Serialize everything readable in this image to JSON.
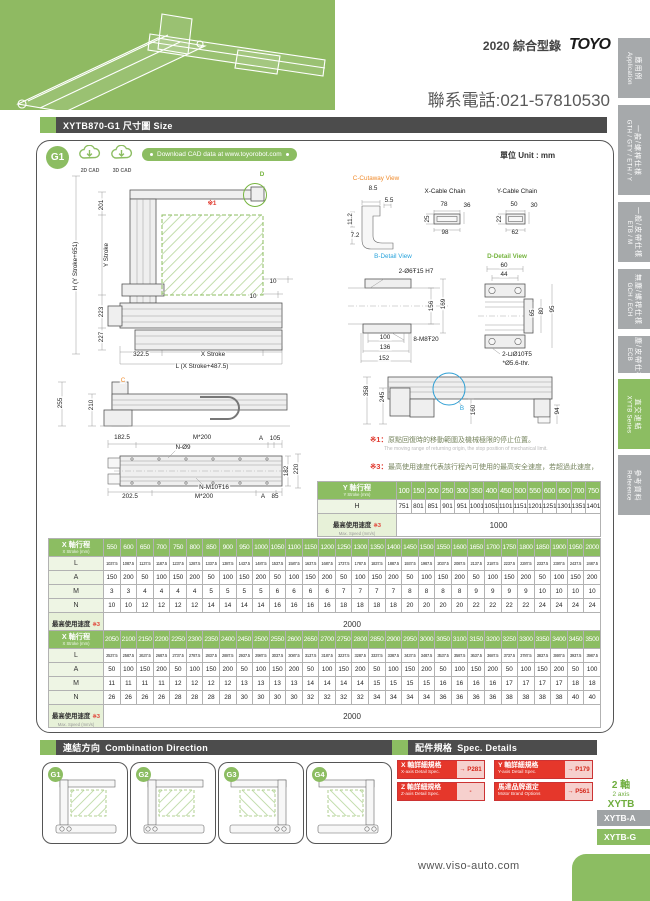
{
  "header": {
    "edition": "2020 綜合型錄",
    "logo": "TOYO",
    "phone": "聯系電話:021-57810530"
  },
  "sidebar": {
    "tabs": [
      {
        "zh": "應用例",
        "en": "Application"
      },
      {
        "zh": "一般/螺桿仕樣",
        "en": "GTH / GTY / ETH / Y"
      },
      {
        "zh": "一般/皮帶仕樣",
        "en": "ETB / M"
      },
      {
        "zh": "無塵/螺桿仕樣",
        "en": "GCH / ECH"
      },
      {
        "zh": "無塵/皮帶仕樣",
        "en": "ECB"
      },
      {
        "zh": "直交連結",
        "en": "XYTB Series"
      },
      {
        "zh": "參考資料",
        "en": "Reference"
      }
    ]
  },
  "size_section": {
    "title": "XYTB870-G1 尺寸圖 Size",
    "badge": "G1",
    "cad_2d": "2D CAD",
    "cad_3d": "3D CAD",
    "download": "Download CAD data at www.toyorobot.com",
    "unit": "單位 Unit : mm"
  },
  "drawings": {
    "front": {
      "labels": [
        {
          "t": "D",
          "x": 210,
          "y": 9,
          "c": "green"
        },
        {
          "t": "※1",
          "x": 160,
          "y": 38,
          "c": "red"
        },
        {
          "t": "H (Y Stroke+651)",
          "x": 24,
          "y": 100,
          "r": -90
        },
        {
          "t": "201",
          "x": 50,
          "y": 39,
          "r": -90
        },
        {
          "t": "Y Stroke",
          "x": 55,
          "y": 89,
          "r": -90
        },
        {
          "t": "223",
          "x": 50,
          "y": 146,
          "r": -90
        },
        {
          "t": "227",
          "x": 50,
          "y": 171,
          "r": -90
        },
        {
          "t": "10",
          "x": 221,
          "y": 116
        },
        {
          "t": "10",
          "x": 201,
          "y": 131
        },
        {
          "t": "322.5",
          "x": 89,
          "y": 189
        },
        {
          "t": "X Stroke",
          "x": 161,
          "y": 189
        },
        {
          "t": "L (X Stroke+487.5)",
          "x": 150,
          "y": 201
        }
      ]
    },
    "details": {
      "labels": [
        {
          "t": "C-Cutaway View",
          "x": 28,
          "y": 7,
          "c": "orange"
        },
        {
          "t": "8.5",
          "x": 25,
          "y": 17
        },
        {
          "t": "5.5",
          "x": 41,
          "y": 29
        },
        {
          "t": "11.2",
          "x": 3,
          "y": 47,
          "r": -90
        },
        {
          "t": "7.2",
          "x": 7,
          "y": 64
        },
        {
          "t": "X-Cable Chain",
          "x": 97,
          "y": 20
        },
        {
          "t": "78",
          "x": 96,
          "y": 33
        },
        {
          "t": "36",
          "x": 119,
          "y": 34
        },
        {
          "t": "25",
          "x": 80,
          "y": 47,
          "r": -90
        },
        {
          "t": "98",
          "x": 97,
          "y": 61
        },
        {
          "t": "Y-Cable Chain",
          "x": 169,
          "y": 20
        },
        {
          "t": "50",
          "x": 166,
          "y": 33
        },
        {
          "t": "30",
          "x": 186,
          "y": 34
        },
        {
          "t": "22",
          "x": 152,
          "y": 47,
          "r": -90
        },
        {
          "t": "62",
          "x": 167,
          "y": 61
        },
        {
          "t": "B-Detail View",
          "x": 45,
          "y": 85,
          "c": "blue"
        },
        {
          "t": "2-Ø6Ŧ15 H7",
          "x": 68,
          "y": 100
        },
        {
          "t": "156",
          "x": 84,
          "y": 134,
          "r": -90
        },
        {
          "t": "169",
          "x": 96,
          "y": 132,
          "r": -90
        },
        {
          "t": "100",
          "x": 37,
          "y": 166
        },
        {
          "t": "8-M8Ŧ20",
          "x": 78,
          "y": 168
        },
        {
          "t": "136",
          "x": 37,
          "y": 176
        },
        {
          "t": "152",
          "x": 36,
          "y": 187
        },
        {
          "t": "D-Detail View",
          "x": 159,
          "y": 85,
          "c": "green"
        },
        {
          "t": "60",
          "x": 156,
          "y": 94
        },
        {
          "t": "44",
          "x": 156,
          "y": 103
        },
        {
          "t": "65",
          "x": 185,
          "y": 141,
          "r": -90
        },
        {
          "t": "80",
          "x": 194,
          "y": 139,
          "r": -90
        },
        {
          "t": "95",
          "x": 205,
          "y": 137,
          "r": -90
        },
        {
          "t": "2-⊔Ø10Ŧ5",
          "x": 169,
          "y": 183
        },
        {
          "t": "*Ø5.6-thr.",
          "x": 168,
          "y": 192
        }
      ]
    },
    "side_top": {
      "labels": [
        {
          "t": "255",
          "x": 9,
          "y": 29,
          "r": -90
        },
        {
          "t": "210",
          "x": 40,
          "y": 31,
          "r": -90
        },
        {
          "t": "C",
          "x": 71,
          "y": 7,
          "c": "orange"
        },
        {
          "t": "182.5",
          "x": 70,
          "y": 64
        },
        {
          "t": "M*200",
          "x": 150,
          "y": 64
        },
        {
          "t": "A",
          "x": 209,
          "y": 65
        },
        {
          "t": "105",
          "x": 223,
          "y": 65
        },
        {
          "t": "N-Ø9",
          "x": 131,
          "y": 74
        },
        {
          "t": "182",
          "x": 235,
          "y": 97,
          "r": -90
        },
        {
          "t": "220",
          "x": 245,
          "y": 95,
          "r": -90
        },
        {
          "t": "N-M10Ŧ16",
          "x": 162,
          "y": 114
        },
        {
          "t": "202.5",
          "x": 78,
          "y": 123
        },
        {
          "t": "M*200",
          "x": 152,
          "y": 123
        },
        {
          "t": "A",
          "x": 211,
          "y": 123
        },
        {
          "t": "85",
          "x": 223,
          "y": 123
        }
      ]
    },
    "right_side": {
      "labels": [
        {
          "t": "358",
          "x": 9,
          "y": 19,
          "r": -90
        },
        {
          "t": "245",
          "x": 25,
          "y": 25,
          "r": -90
        },
        {
          "t": "B",
          "x": 104,
          "y": 37,
          "c": "blue"
        },
        {
          "t": "160",
          "x": 116,
          "y": 38,
          "r": -90
        },
        {
          "t": "94",
          "x": 200,
          "y": 39,
          "r": -90
        }
      ]
    }
  },
  "notes": [
    {
      "mark": "※1：",
      "zh": "原點回復時的移動範圍及機械極限的停止位置。",
      "en": "The moving range of returning origin, the stop position of mechanical limit."
    },
    {
      "mark": "※3：",
      "zh": "最高使用速度代表該行程內可使用的最高安全速度，若超過此速度，滑台可能會有嚴重共振產生。",
      "en": "Maximum speed is refers to the highest safe speed that can be used in stroke. If more than the standard speed, it may occur serious resonance."
    }
  ],
  "tables": {
    "y": {
      "head": {
        "zh": "Y 軸行程",
        "sub": "Y Stroke (mm)"
      },
      "columns": [
        "100",
        "150",
        "200",
        "250",
        "300",
        "350",
        "400",
        "450",
        "500",
        "550",
        "600",
        "650",
        "700",
        "750"
      ],
      "rows": [
        {
          "label": "H",
          "values": [
            751,
            801,
            851,
            901,
            951,
            1001,
            1051,
            1101,
            1151,
            1201,
            1251,
            1301,
            1351,
            1401
          ]
        }
      ],
      "speed": {
        "zh": "最高使用速度",
        "mark": "※3",
        "sub": "Max. Speed (mm/s)",
        "value": "1000"
      }
    },
    "x1": {
      "head": {
        "zh": "X 軸行程",
        "sub": "X Stroke (mm)"
      },
      "columns": [
        "550",
        "600",
        "650",
        "700",
        "750",
        "800",
        "850",
        "900",
        "950",
        "1000",
        "1050",
        "1100",
        "1150",
        "1200",
        "1250",
        "1300",
        "1350",
        "1400",
        "1450",
        "1500",
        "1550",
        "1600",
        "1650",
        "1700",
        "1750",
        "1800",
        "1850",
        "1900",
        "1950",
        "2000"
      ],
      "rows": [
        {
          "label": "L",
          "values": [
            1037.5,
            1087.5,
            1137.5,
            1187.5,
            1237.5,
            1287.5,
            1337.5,
            1387.5,
            1437.5,
            1487.5,
            1537.5,
            1587.5,
            1637.5,
            1687.5,
            1737.5,
            1787.5,
            1837.5,
            1887.5,
            1937.5,
            1987.5,
            2037.5,
            2087.5,
            2137.5,
            2187.5,
            2237.5,
            2287.5,
            2337.5,
            2387.5,
            2437.5,
            2487.5
          ]
        },
        {
          "label": "A",
          "values": [
            150,
            200,
            50,
            100,
            150,
            200,
            50,
            100,
            150,
            200,
            50,
            100,
            150,
            200,
            50,
            100,
            150,
            200,
            50,
            100,
            150,
            200,
            50,
            100,
            150,
            200,
            50,
            100,
            150,
            200
          ]
        },
        {
          "label": "M",
          "values": [
            3,
            3,
            4,
            4,
            4,
            4,
            5,
            5,
            5,
            5,
            6,
            6,
            6,
            6,
            7,
            7,
            7,
            7,
            8,
            8,
            8,
            8,
            9,
            9,
            9,
            9,
            10,
            10,
            10,
            10
          ]
        },
        {
          "label": "N",
          "values": [
            10,
            10,
            12,
            12,
            12,
            12,
            14,
            14,
            14,
            14,
            16,
            16,
            16,
            16,
            18,
            18,
            18,
            18,
            20,
            20,
            20,
            20,
            22,
            22,
            22,
            22,
            24,
            24,
            24,
            24
          ]
        }
      ],
      "speed": {
        "zh": "最高使用速度",
        "mark": "※3",
        "sub": "Max. Speed (mm/s)",
        "value": "2000"
      }
    },
    "x2": {
      "head": {
        "zh": "X 軸行程",
        "sub": "X Stroke (mm)"
      },
      "columns": [
        "2050",
        "2100",
        "2150",
        "2200",
        "2250",
        "2300",
        "2350",
        "2400",
        "2450",
        "2500",
        "2550",
        "2600",
        "2650",
        "2700",
        "2750",
        "2800",
        "2850",
        "2900",
        "2950",
        "3000",
        "3050",
        "3100",
        "3150",
        "3200",
        "3250",
        "3300",
        "3350",
        "3400",
        "3450",
        "3500"
      ],
      "rows": [
        {
          "label": "L",
          "values": [
            2537.5,
            2587.5,
            2637.5,
            2687.5,
            2737.5,
            2787.5,
            2837.5,
            2887.5,
            2937.5,
            2987.5,
            3037.5,
            3087.5,
            3137.5,
            3187.5,
            3237.5,
            3287.5,
            3337.5,
            3387.5,
            3437.5,
            3487.5,
            3537.5,
            3587.5,
            3637.5,
            3687.5,
            3737.5,
            3787.5,
            3837.5,
            3887.5,
            3937.5,
            3987.5
          ]
        },
        {
          "label": "A",
          "values": [
            50,
            100,
            150,
            200,
            50,
            100,
            150,
            200,
            50,
            100,
            150,
            200,
            50,
            100,
            150,
            200,
            50,
            100,
            150,
            200,
            50,
            100,
            150,
            200,
            50,
            100,
            150,
            200,
            50,
            100
          ]
        },
        {
          "label": "M",
          "values": [
            11,
            11,
            11,
            11,
            12,
            12,
            12,
            12,
            13,
            13,
            13,
            13,
            14,
            14,
            14,
            14,
            15,
            15,
            15,
            15,
            16,
            16,
            16,
            16,
            17,
            17,
            17,
            17,
            18,
            18
          ]
        },
        {
          "label": "N",
          "values": [
            26,
            26,
            26,
            26,
            28,
            28,
            28,
            28,
            30,
            30,
            30,
            30,
            32,
            32,
            32,
            32,
            34,
            34,
            34,
            34,
            36,
            36,
            36,
            36,
            38,
            38,
            38,
            38,
            40,
            40
          ]
        }
      ],
      "speed": {
        "zh": "最高使用速度",
        "mark": "※3",
        "sub": "Max. Speed (mm/s)",
        "value": "2000"
      }
    }
  },
  "combination": {
    "title_zh": "連結方向",
    "title_en": "Combination Direction",
    "items": [
      "G1",
      "G2",
      "G3",
      "G4"
    ]
  },
  "spec_details": {
    "title_zh": "配件規格",
    "title_en": "Spec. Details",
    "items": [
      {
        "zh": "X 軸詳細規格",
        "en": "X-axis Detail Spec.",
        "page": "→ P281"
      },
      {
        "zh": "Y 軸詳細規格",
        "en": "Y-axis Detail Spec.",
        "page": "→ P179"
      },
      {
        "zh": "Z 軸詳細規格",
        "en": "Z-axis Detail Spec.",
        "page": "-"
      },
      {
        "zh": "馬達品牌選定",
        "en": "Motor Brand Options",
        "page": "→ P561"
      }
    ]
  },
  "series_nav": {
    "axis_zh": "2 軸",
    "axis_en": "2 axis",
    "series": "XYTB",
    "tabs": [
      {
        "label": "XYTB-A"
      },
      {
        "label": "XYTB-G"
      }
    ]
  },
  "footer": {
    "website": "www.viso-auto.com"
  }
}
